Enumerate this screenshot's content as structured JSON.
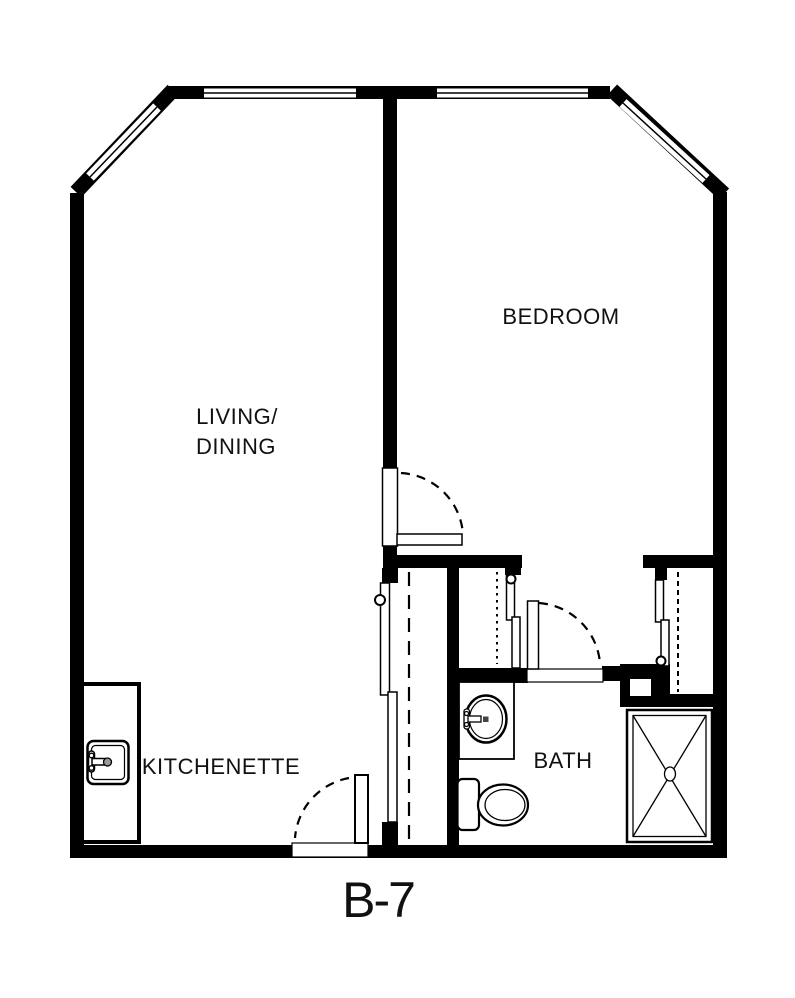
{
  "floor_plan": {
    "title": "B-7",
    "rooms": {
      "living_dining": {
        "line1": "LIVING/",
        "line2": "DINING"
      },
      "bedroom": {
        "label": "BEDROOM"
      },
      "kitchenette": {
        "label": "KITCHENETTE"
      },
      "bath": {
        "label": "BATH"
      }
    },
    "fixture_symbols": [
      "kitchen-sink",
      "bathroom-sink",
      "toilet",
      "shower",
      "entry-door",
      "bedroom-door",
      "bath-door",
      "closet-sliding-doors",
      "windows"
    ],
    "colors": {
      "walls": "#000000",
      "background": "#ffffff",
      "lines": "#111111"
    }
  }
}
